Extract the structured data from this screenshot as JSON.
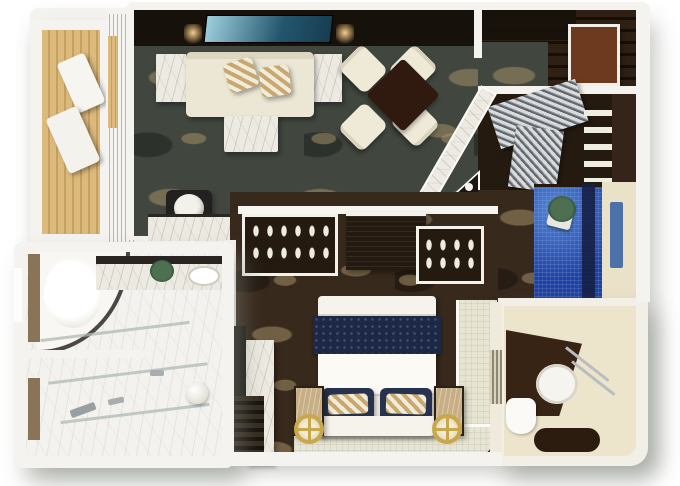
{
  "scene": {
    "type": "3d-floorplan-render",
    "rooms": [
      {
        "name": "balcony",
        "features": [
          "wood-deck",
          "lounge-chair-1",
          "lounge-chair-2",
          "railing-wall"
        ]
      },
      {
        "name": "living-room",
        "features": [
          "media-wall",
          "tv-screen",
          "sconce-left",
          "sconce-right",
          "sofa",
          "striped-pillows",
          "side-table-left",
          "side-table-right",
          "coffee-table",
          "round-stool",
          "marble-console",
          "floral-carpet"
        ]
      },
      {
        "name": "dining-area",
        "features": [
          "square-dark-table",
          "dining-chair-1",
          "dining-chair-2",
          "dining-chair-3",
          "dining-chair-4"
        ]
      },
      {
        "name": "entry-hall",
        "features": [
          "dark-wood-floor",
          "entry-door",
          "entry-rug",
          "ceiling-beams"
        ]
      },
      {
        "name": "walk-in-closet",
        "features": [
          "accordion-door-upper",
          "accordion-door-lower",
          "shelf-stack",
          "wardrobe-cabinet",
          "minibar-cabinet",
          "glassware"
        ]
      },
      {
        "name": "shower-room",
        "features": [
          "blue-mosaic-shower",
          "glass-navy-stripe",
          "plant",
          "towel-rail",
          "beige-wall"
        ]
      },
      {
        "name": "guest-bathroom",
        "features": [
          "vanity-counter",
          "vanity-sink",
          "towel-bars",
          "toilet",
          "bath-mat",
          "beige-floor"
        ]
      },
      {
        "name": "bedroom",
        "features": [
          "shoe-cabinet-left",
          "dresser",
          "shoe-cabinet-right",
          "bed",
          "navy-runner",
          "navy-pillows",
          "gold-striped-shams",
          "nightstand-left",
          "nightstand-right",
          "gold-ring-lamp-left",
          "gold-ring-lamp-right",
          "cream-tile-runner",
          "marble-pillar",
          "louver-closet",
          "floral-carpet"
        ]
      },
      {
        "name": "master-bathroom",
        "features": [
          "curved-tub-enclosure",
          "bathtub",
          "marble-counter",
          "counter-sink",
          "plant",
          "glass-partitions",
          "round-basin",
          "fixtures",
          "wood-door-panels",
          "marble-floor"
        ]
      }
    ]
  },
  "palette": {
    "bg": "#ffffff",
    "wall": "#f4f3ef",
    "wall-shade": "#dbd9d1",
    "shadow": "rgba(128,134,124,0.45)",
    "carpet-living": "#41463f",
    "carpet-bedroom": "#37291c",
    "carpet-motif": "rgba(162,142,102,0.55)",
    "media-wall": "#17110b",
    "tv-1": "#9fd0de",
    "tv-2": "#23566e",
    "sofa": "#ece7d5",
    "pillow-stripe-1": "#c8a86f",
    "pillow-stripe-2": "#f1ebd9",
    "marble": "#edeae1",
    "marble-vein": "rgba(120,122,118,0.25)",
    "wood-deck-1": "#dcb97c",
    "wood-deck-2": "#c6a05e",
    "dining-table": "#30190e",
    "chair": "#efe9d8",
    "entry-floor-1": "#2e2114",
    "entry-floor-2": "#160f08",
    "door": "#6e3a1f",
    "slat-light": "#d8dcdf",
    "slat-dark": "#63676b",
    "closet-dark": "#241a10",
    "shower-blue": "#1d41a3",
    "shower-navy": "#161f46",
    "plant": "#4c7050",
    "beige-wall": "#e9e1c8",
    "towel-blue": "#4c70a8",
    "vanity-brown": "#382415",
    "bathroom2-floor": "#ece4cb",
    "rug-dark": "#2c1c10",
    "bed-white": "#f5f3eb",
    "bed-navy": "#1d2847",
    "pillow-navy": "#27324f",
    "platform-cream": "#e7e4d1",
    "gold": "#c9a84c",
    "bath-marble": "#f3f2ee",
    "glass": "rgba(175,185,182,0.75)",
    "wood-door-light": "#8a7458",
    "nightstand-tan": "#c7ae85",
    "glow-warm": "rgba(255,216,150,0.95)"
  }
}
